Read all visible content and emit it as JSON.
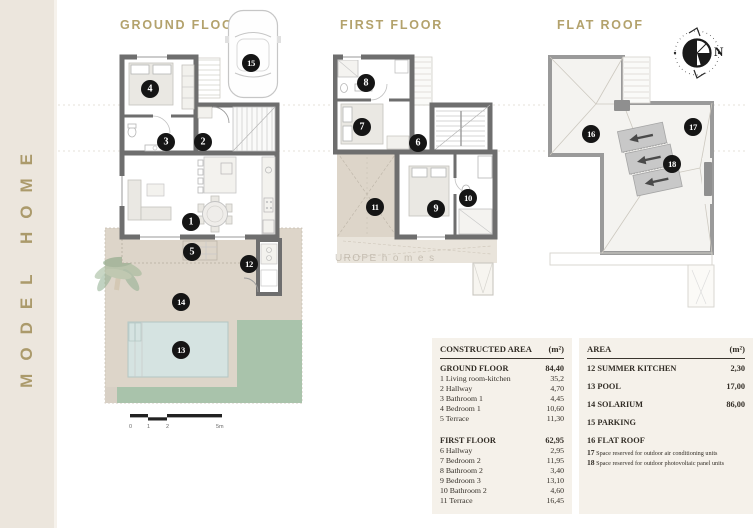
{
  "sidebar": {
    "brand": "MODEL HOME"
  },
  "colors": {
    "accent_gold": "#b3a26c",
    "sidebar_bg": "#ece6dd",
    "wall_gray": "#6e6e6e",
    "terrace_beige": "#ddd5c9",
    "pool_blue": "#d5e3e1",
    "lawn_green": "#a9c3ab",
    "table_bg": "#f5f1ea",
    "marker_black": "#151515"
  },
  "plans": {
    "ground": {
      "title": "GROUND FLOOR",
      "markers": {
        "living": "1",
        "hall": "2",
        "bath1": "3",
        "bed1": "4",
        "terrace": "5",
        "summer_kitchen": "12",
        "pool": "13",
        "solarium": "14",
        "parking": "15"
      }
    },
    "first": {
      "title": "FIRST FLOOR",
      "markers": {
        "hall": "6",
        "bed2": "7",
        "bath2": "8",
        "bed3": "9",
        "bath3": "10",
        "terrace": "11"
      }
    },
    "roof": {
      "title": "FLAT ROOF",
      "compass_n": "N",
      "markers": {
        "flat_roof": "16",
        "ac": "17",
        "pv": "18"
      }
    }
  },
  "scalebar": {
    "labels": [
      "0",
      "1",
      "2",
      "5m"
    ]
  },
  "watermark": "UROPE h o m e s",
  "constructed_table": {
    "header": {
      "label": "CONSTRUCTED AREA",
      "unit": "(m²)"
    },
    "ground_total": {
      "label": "GROUND FLOOR",
      "value": "84,40"
    },
    "ground_rows": [
      {
        "label": "1 Living room-kitchen",
        "value": "35,2"
      },
      {
        "label": "2 Hallway",
        "value": "4,70"
      },
      {
        "label": "3 Bathroom 1",
        "value": "4,45"
      },
      {
        "label": "4 Bedroom 1",
        "value": "10,60"
      },
      {
        "label": "5 Terrace",
        "value": "11,30"
      }
    ],
    "first_total": {
      "label": "FIRST FLOOR",
      "value": "62,95"
    },
    "first_rows": [
      {
        "label": "6 Hallway",
        "value": "2,95"
      },
      {
        "label": "7 Bedroom 2",
        "value": "11,95"
      },
      {
        "label": "8 Bathroom 2",
        "value": "3,40"
      },
      {
        "label": "9 Bedroom 3",
        "value": "13,10"
      },
      {
        "label": "10 Bathroom 2",
        "value": "4,60"
      },
      {
        "label": "11 Terrace",
        "value": "16,45"
      }
    ]
  },
  "area_table": {
    "header": {
      "label": "AREA",
      "unit": "(m²)"
    },
    "rows": [
      {
        "label": "12 SUMMER KITCHEN",
        "value": "2,30"
      },
      {
        "label": "13 POOL",
        "value": "17,00"
      },
      {
        "label": "14 SOLARIUM",
        "value": "86,00"
      },
      {
        "label": "15 PARKING",
        "value": ""
      },
      {
        "label": "16 FLAT ROOF",
        "value": ""
      }
    ],
    "notes": [
      {
        "num": "17",
        "text": "Space reserved for outdoor air conditioning units"
      },
      {
        "num": "18",
        "text": "Space reserved for outdoor photovoltaic panel units"
      }
    ]
  }
}
